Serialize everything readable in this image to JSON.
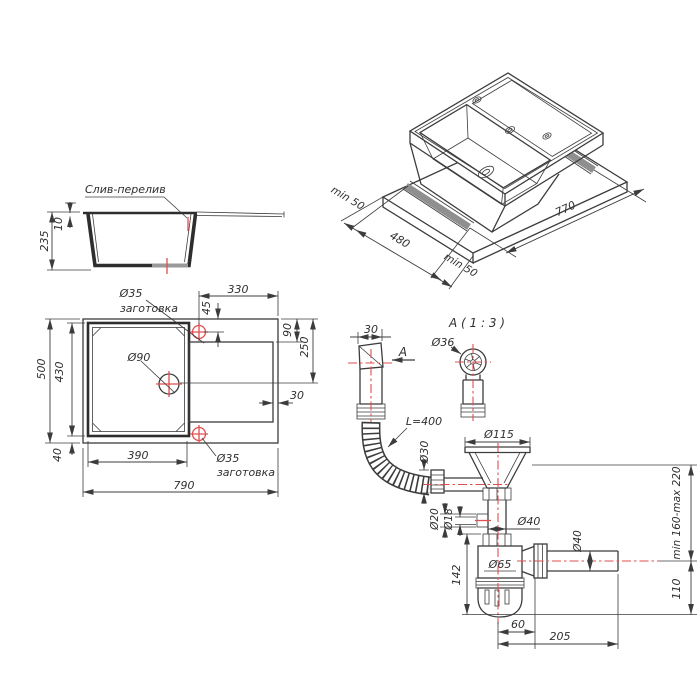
{
  "meta": {
    "background": "#ffffff",
    "line_color": "#3c3c3c",
    "accent_red": "#e04f4f",
    "shade_gray": "#8f8f8f"
  },
  "side_view": {
    "overflow_label": "Слив-перелив",
    "total_height": "235",
    "rim_height": "10"
  },
  "plan_view": {
    "total_width": "790",
    "total_depth": "500",
    "bowl_depth": "430",
    "bowl_width": "390",
    "edge_offset": "40",
    "board_width": "330",
    "hole_offset": "45",
    "board_top_offset": "90",
    "board_center_offset": "250",
    "board_edge_offset": "30",
    "drain_dia": "Ø90",
    "hole_top_dia": "Ø35",
    "hole_top_note": "заготовка",
    "hole_bottom_dia": "Ø35",
    "hole_bottom_note": "заготовка"
  },
  "iso_view": {
    "cutout_length": "770",
    "cutout_width": "480",
    "margin_left": "min 50",
    "margin_right": "min 50"
  },
  "siphon_view": {
    "overflow_pipe_width": "30",
    "view_arrow_label": "A",
    "detail_title": "A ( 1 : 3 )",
    "overflow_head_dia": "Ø36",
    "hose_length": "L=400",
    "hose_dia": "Ø30",
    "flange_dia": "Ø115",
    "stub_outer_dia": "Ø20",
    "stub_inner_dia": "Ø18",
    "pipe_dia": "Ø40",
    "body_dia": "Ø65",
    "outlet_dia": "Ø40",
    "body_height": "142",
    "adjust_range": "min 160-max 220",
    "outlet_height": "110",
    "outlet_offset": "60",
    "outlet_length": "205"
  }
}
